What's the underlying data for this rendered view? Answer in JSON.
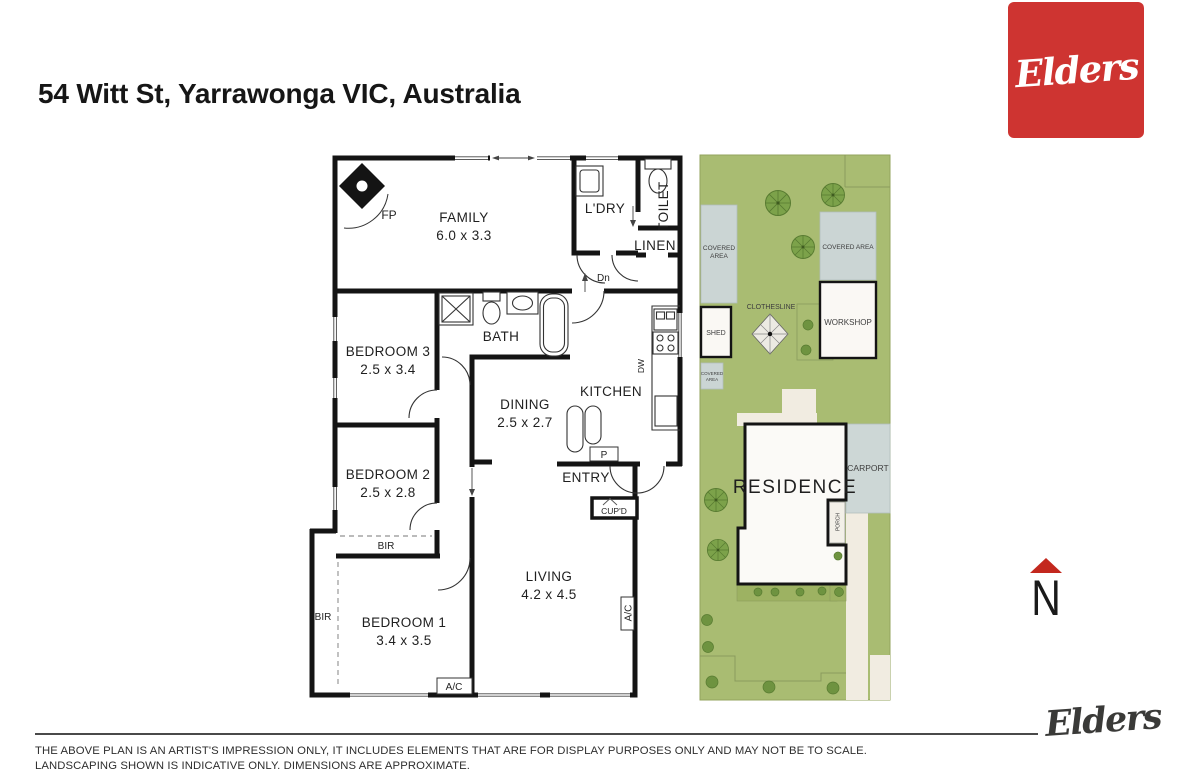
{
  "header": {
    "title": "54 Witt St, Yarrawonga VIC, Australia"
  },
  "brand": {
    "logo_text": "Elders"
  },
  "floorplan": {
    "rooms": {
      "family": {
        "name": "FAMILY",
        "dims": "6.0 x 3.3"
      },
      "ldry": {
        "name": "L'DRY"
      },
      "toilet": {
        "name": "TOILET"
      },
      "linen": {
        "name": "LINEN"
      },
      "bath": {
        "name": "BATH"
      },
      "bedroom3": {
        "name": "BEDROOM 3",
        "dims": "2.5 x 3.4"
      },
      "bedroom2": {
        "name": "BEDROOM 2",
        "dims": "2.5 x 2.8"
      },
      "bedroom1": {
        "name": "BEDROOM 1",
        "dims": "3.4 x 3.5"
      },
      "dining": {
        "name": "DINING",
        "dims": "2.5 x 2.7"
      },
      "kitchen": {
        "name": "KITCHEN"
      },
      "living": {
        "name": "LIVING",
        "dims": "4.2 x 4.5"
      },
      "entry": {
        "name": "ENTRY"
      }
    },
    "features": {
      "fp": "FP",
      "dn": "Dn",
      "bir": "BIR",
      "ac": "A/C",
      "p": "P",
      "cupd": "CUP'D",
      "dw": "DW"
    }
  },
  "siteplan": {
    "covered_area": "COVERED AREA",
    "covered": "COVERED",
    "area": "AREA",
    "shed": "SHED",
    "clothesline": "CLOTHESLINE",
    "workshop": "WORKSHOP",
    "residence": "RESIDENCE",
    "carport": "CARPORT",
    "porch": "PORCH"
  },
  "compass": {
    "north": "N"
  },
  "footer": {
    "line1": "THE ABOVE PLAN IS AN ARTIST'S IMPRESSION ONLY, IT INCLUDES ELEMENTS THAT ARE FOR DISPLAY PURPOSES ONLY AND MAY NOT BE TO SCALE.",
    "line2": "LANDSCAPING SHOWN IS INDICATIVE ONLY. DIMENSIONS ARE APPROXIMATE."
  },
  "colors": {
    "brand_red": "#CE3431",
    "site_green": "#A9BC72",
    "covered_gray": "#CBD5D4",
    "north_red": "#C3281E"
  }
}
